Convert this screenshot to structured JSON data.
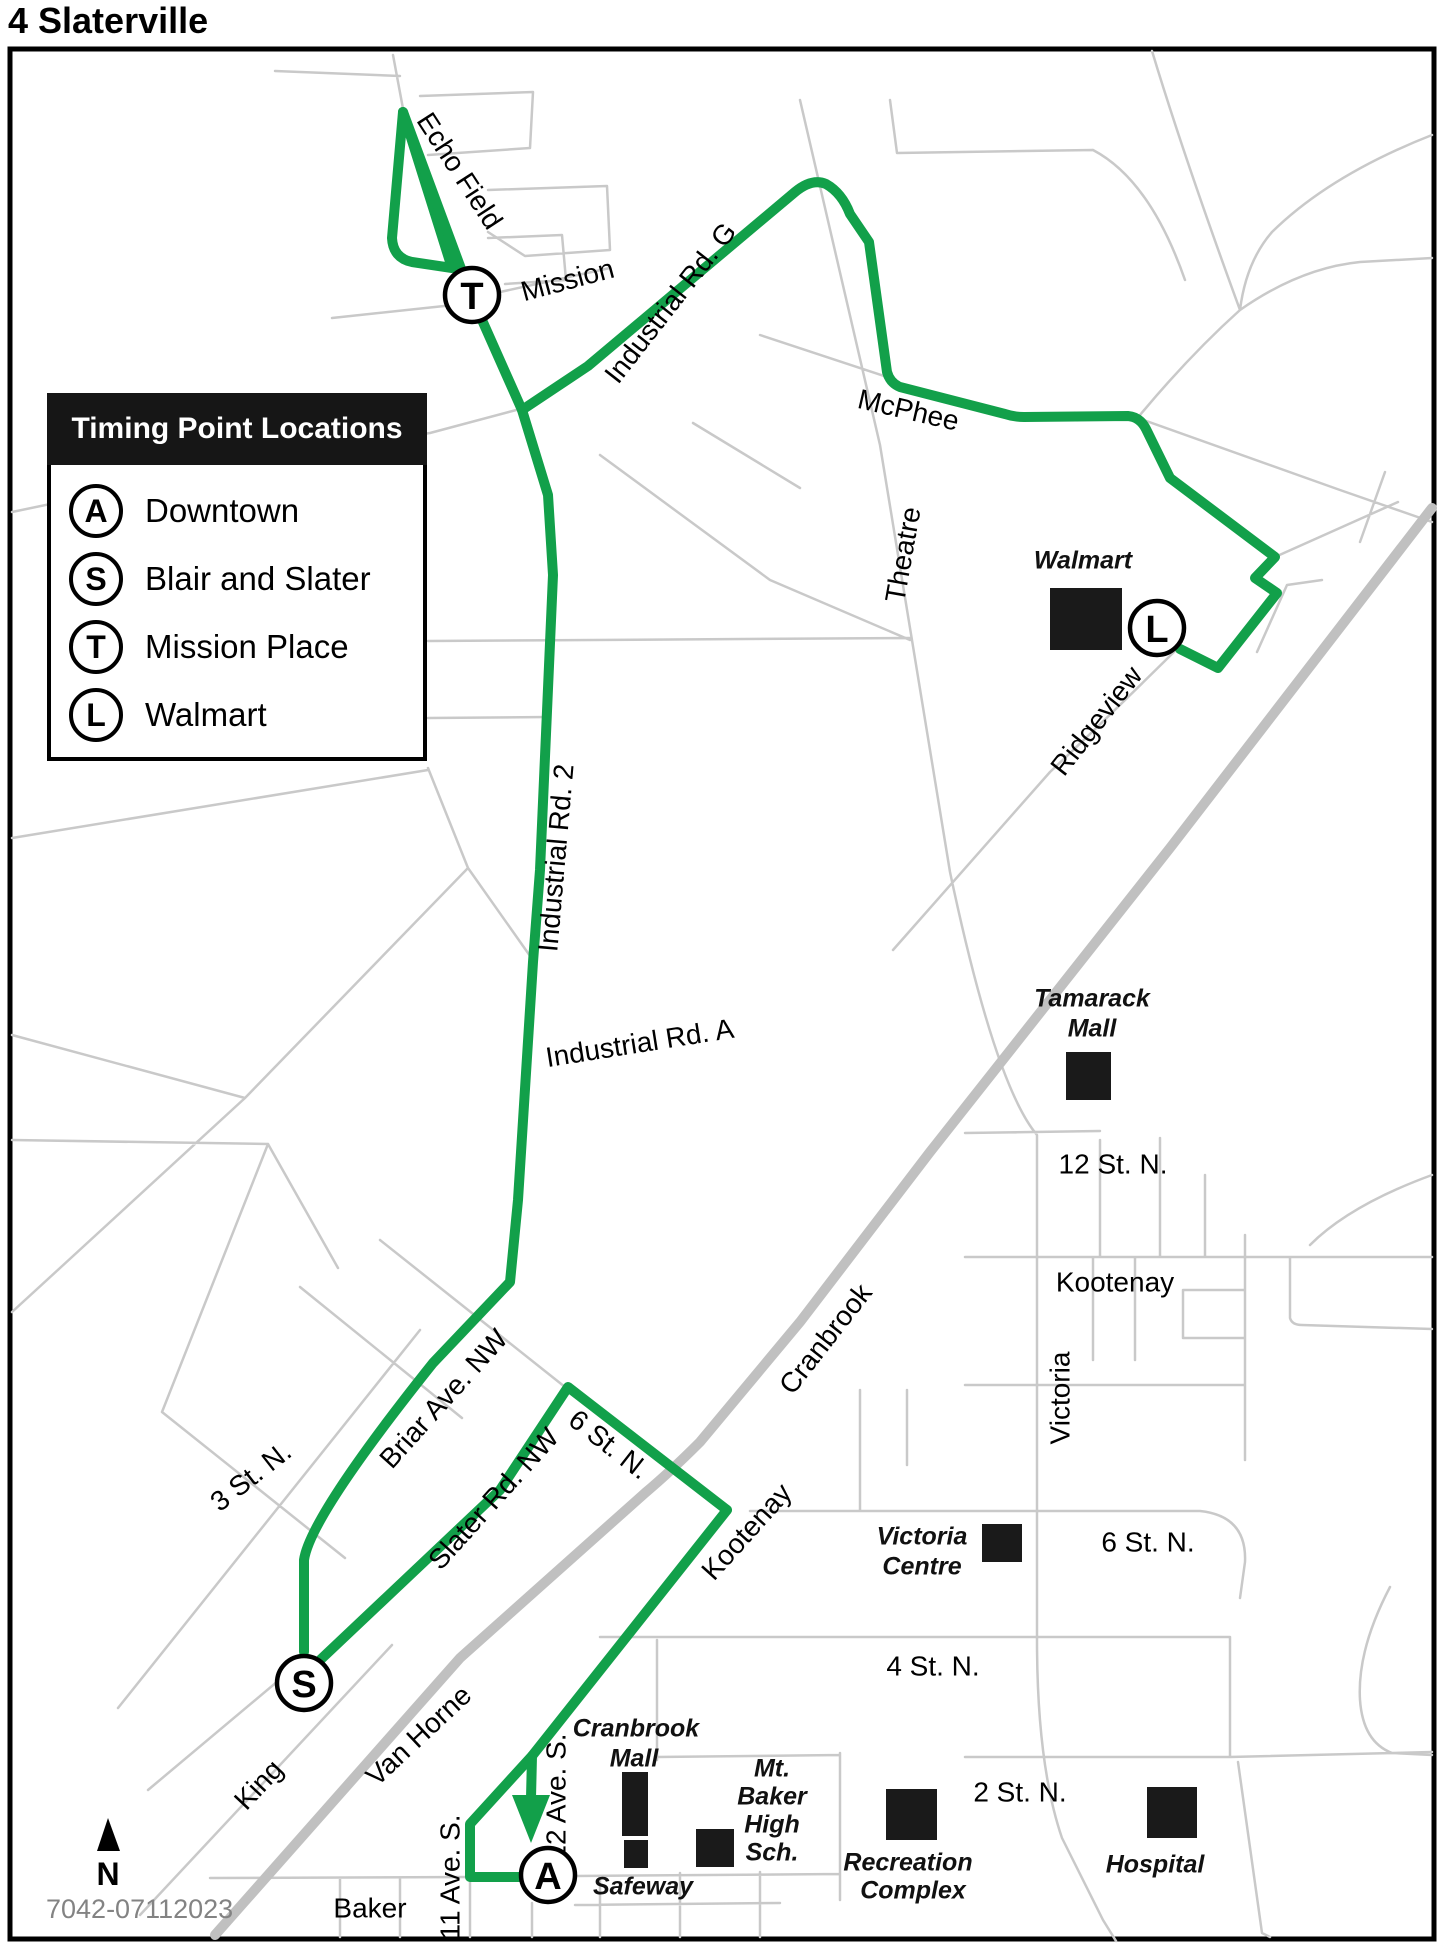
{
  "title": "4 Slaterville",
  "map_code": "7042-07112023",
  "colors": {
    "route": "#12a04a",
    "road": "#c9c9c9",
    "highway": "#c0c0c0",
    "building": "#1a1a1a"
  },
  "compass": {
    "label": "N"
  },
  "legend": {
    "header": "Timing Point Locations",
    "items": [
      {
        "letter": "A",
        "label": "Downtown"
      },
      {
        "letter": "S",
        "label": "Blair and Slater"
      },
      {
        "letter": "T",
        "label": "Mission Place"
      },
      {
        "letter": "L",
        "label": "Walmart"
      }
    ]
  },
  "timing_points": [
    {
      "letter": "T",
      "name": "Mission Place",
      "x": 472,
      "y": 295
    },
    {
      "letter": "L",
      "name": "Walmart",
      "x": 1157,
      "y": 628
    },
    {
      "letter": "S",
      "name": "Blair and Slater",
      "x": 304,
      "y": 1683
    },
    {
      "letter": "A",
      "name": "Downtown",
      "x": 548,
      "y": 1875
    }
  ],
  "map_labels": [
    {
      "text": "Echo Field",
      "x": 458,
      "y": 172,
      "r": 57
    },
    {
      "text": "Mission",
      "x": 568,
      "y": 282,
      "r": -15
    },
    {
      "text": "Industrial Rd. G",
      "x": 672,
      "y": 304,
      "r": -52
    },
    {
      "text": "McPhee",
      "x": 908,
      "y": 412,
      "r": 13
    },
    {
      "text": "Theatre",
      "x": 905,
      "y": 555,
      "r": -80
    },
    {
      "text": "Walmart",
      "x": 1083,
      "y": 562,
      "kind": "place"
    },
    {
      "text": "Ridgeview",
      "x": 1098,
      "y": 722,
      "r": -52
    },
    {
      "text": "Industrial Rd. 2",
      "x": 558,
      "y": 858,
      "r": -85
    },
    {
      "text": "Industrial Rd. A",
      "x": 640,
      "y": 1045,
      "r": -9
    },
    {
      "text": "Tamarack",
      "x": 1092,
      "y": 1000,
      "kind": "place"
    },
    {
      "text": "Mall",
      "x": 1092,
      "y": 1030,
      "kind": "place"
    },
    {
      "text": "12 St. N.",
      "x": 1113,
      "y": 1166
    },
    {
      "text": "Kootenay",
      "x": 1115,
      "y": 1284
    },
    {
      "text": "Victoria",
      "x": 1062,
      "y": 1398,
      "r": -90
    },
    {
      "text": "Kootenay",
      "x": 748,
      "y": 1533,
      "r": -48
    },
    {
      "text": "Victoria",
      "x": 922,
      "y": 1538,
      "kind": "place"
    },
    {
      "text": "Centre",
      "x": 922,
      "y": 1568,
      "kind": "place"
    },
    {
      "text": "6  St. N.",
      "x": 1148,
      "y": 1544
    },
    {
      "text": "4  St. N.",
      "x": 933,
      "y": 1668
    },
    {
      "text": "2 St. N.",
      "x": 1020,
      "y": 1794
    },
    {
      "text": "Hospital",
      "x": 1155,
      "y": 1866,
      "kind": "place"
    },
    {
      "text": "Recreation",
      "x": 908,
      "y": 1864,
      "kind": "place"
    },
    {
      "text": "Complex",
      "x": 913,
      "y": 1892,
      "kind": "place"
    },
    {
      "text": "Mt.",
      "x": 772,
      "y": 1770,
      "kind": "place"
    },
    {
      "text": "Baker",
      "x": 772,
      "y": 1798,
      "kind": "place"
    },
    {
      "text": "High",
      "x": 772,
      "y": 1826,
      "kind": "place"
    },
    {
      "text": "Sch.",
      "x": 772,
      "y": 1854,
      "kind": "place"
    },
    {
      "text": "Safeway",
      "x": 643,
      "y": 1888,
      "kind": "place"
    },
    {
      "text": "Cranbrook",
      "x": 636,
      "y": 1730,
      "kind": "place"
    },
    {
      "text": "Mall",
      "x": 634,
      "y": 1760,
      "kind": "place"
    },
    {
      "text": "Cranbrook",
      "x": 827,
      "y": 1340,
      "r": -52
    },
    {
      "text": "Briar Ave. NW",
      "x": 445,
      "y": 1400,
      "r": -48
    },
    {
      "text": "Slater Rd. NW",
      "x": 495,
      "y": 1500,
      "r": -48
    },
    {
      "text": "6 St. N.",
      "x": 608,
      "y": 1446,
      "r": 38
    },
    {
      "text": "3 St. N.",
      "x": 252,
      "y": 1478,
      "r": -38
    },
    {
      "text": "Van Horne",
      "x": 420,
      "y": 1737,
      "r": -43
    },
    {
      "text": "King",
      "x": 260,
      "y": 1786,
      "r": -47
    },
    {
      "text": "Baker",
      "x": 370,
      "y": 1910
    },
    {
      "text": "11 Ave. S.",
      "x": 452,
      "y": 1877,
      "r": -90
    },
    {
      "text": "12 Ave. S.",
      "x": 558,
      "y": 1797,
      "r": -90
    }
  ],
  "buildings": [
    {
      "name": "walmart-square",
      "x": 1050,
      "y": 588,
      "w": 72,
      "h": 62
    },
    {
      "name": "tamarack-mall-square",
      "x": 1066,
      "y": 1052,
      "w": 45,
      "h": 48
    },
    {
      "name": "victoria-centre-square",
      "x": 982,
      "y": 1524,
      "w": 40,
      "h": 38
    },
    {
      "name": "hospital-square",
      "x": 1147,
      "y": 1787,
      "w": 50,
      "h": 51
    },
    {
      "name": "recreation-complex-square",
      "x": 886,
      "y": 1789,
      "w": 51,
      "h": 51
    },
    {
      "name": "safeway-square",
      "x": 696,
      "y": 1829,
      "w": 38,
      "h": 38
    },
    {
      "name": "cranbrook-mall-building-1",
      "x": 622,
      "y": 1772,
      "w": 26,
      "h": 64
    },
    {
      "name": "cranbrook-mall-building-2",
      "x": 624,
      "y": 1840,
      "w": 24,
      "h": 28
    }
  ]
}
